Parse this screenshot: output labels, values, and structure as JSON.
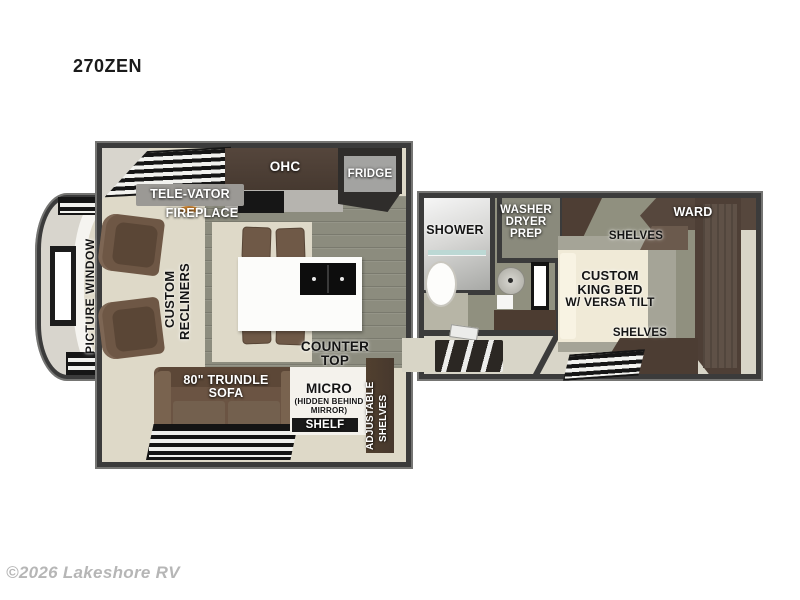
{
  "header": {
    "model": "270ZEN"
  },
  "watermark": {
    "text": "©2026 Lakeshore RV"
  },
  "rooms": {
    "living": {
      "televator": "TELE-VATOR",
      "fireplace": "FIREPLACE",
      "ohc": "OHC",
      "fridge": "FRIDGE",
      "picture_window": "PICTURE WINDOW",
      "recliners_line1": "CUSTOM",
      "recliners_line2": "RECLINERS",
      "counter_line1": "COUNTER",
      "counter_line2": "TOP",
      "sofa_line1": "80\" TRUNDLE",
      "sofa_line2": "SOFA",
      "micro_line1": "MICRO",
      "micro_line2": "(HIDDEN BEHIND",
      "micro_line3": "MIRROR)",
      "shelf": "SHELF",
      "adj_line1": "ADJUSTABLE",
      "adj_line2": "SHELVES"
    },
    "bath": {
      "shower": "SHOWER",
      "wdp_line1": "WASHER",
      "wdp_line2": "DRYER",
      "wdp_line3": "PREP"
    },
    "bedroom": {
      "ward": "WARD",
      "shelves_top": "SHELVES",
      "bed_line1": "CUSTOM",
      "bed_line2": "KING BED",
      "bed_line3": "W/ VERSA TILT",
      "shelves_bottom": "SHELVES"
    }
  },
  "colors": {
    "wall": "#3b3b3b",
    "floor_wood": "#8c8c7e",
    "floor_carpet": "#ded9c8",
    "cabinet_dark": "#4a3c33",
    "upholstery_brown": "#6b5443",
    "bed_cream": "#f0ead7",
    "island_white": "#fcfcfa",
    "fridge_gray": "#a3a3a1",
    "label_white": "#ffffff",
    "label_black": "#141414"
  }
}
